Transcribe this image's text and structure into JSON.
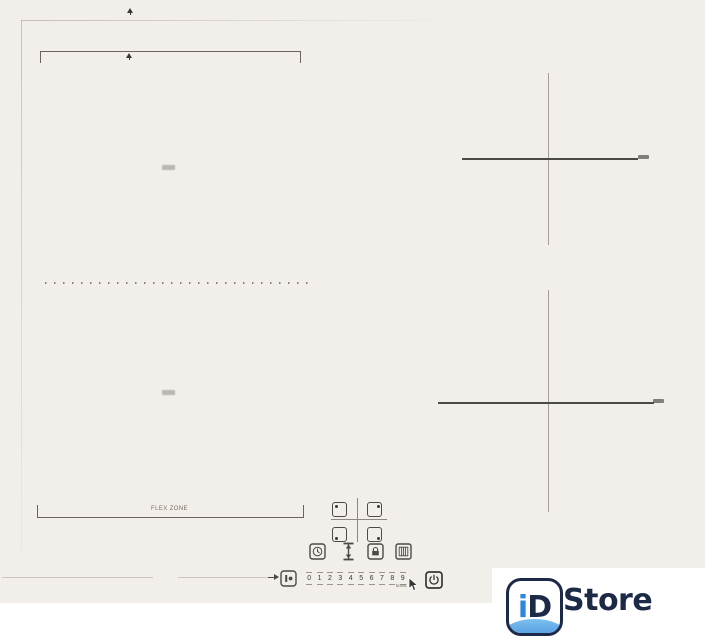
{
  "hob": {
    "flex_zone_label": "FLEX ZONE"
  },
  "controls": {
    "slider": {
      "numbers": [
        "0",
        "1",
        "2",
        "3",
        "4",
        "5",
        "6",
        "7",
        "8",
        "9"
      ],
      "boost_label": "boost"
    },
    "icons": {
      "zone_selector": "four-zone-select-keys",
      "timer": "timer-clock-icon",
      "bridge": "bridge-flex-icon",
      "lock": "child-lock-icon",
      "keep_warm": "keep-warm-grill-icon",
      "stop_go": "stop-go-icon",
      "power": "power-icon",
      "cursor": "hand-cursor-icon"
    }
  },
  "watermark": {
    "badge_text_i": "i",
    "badge_text_d": "D",
    "name_text": "Store",
    "navy": "#1c2947",
    "blue": "#2f87dd"
  },
  "colors": {
    "surface": "#f2efeb",
    "line_dark": "#4c4a46",
    "line_light": "#a39e97",
    "bracket": "#6e625a"
  }
}
